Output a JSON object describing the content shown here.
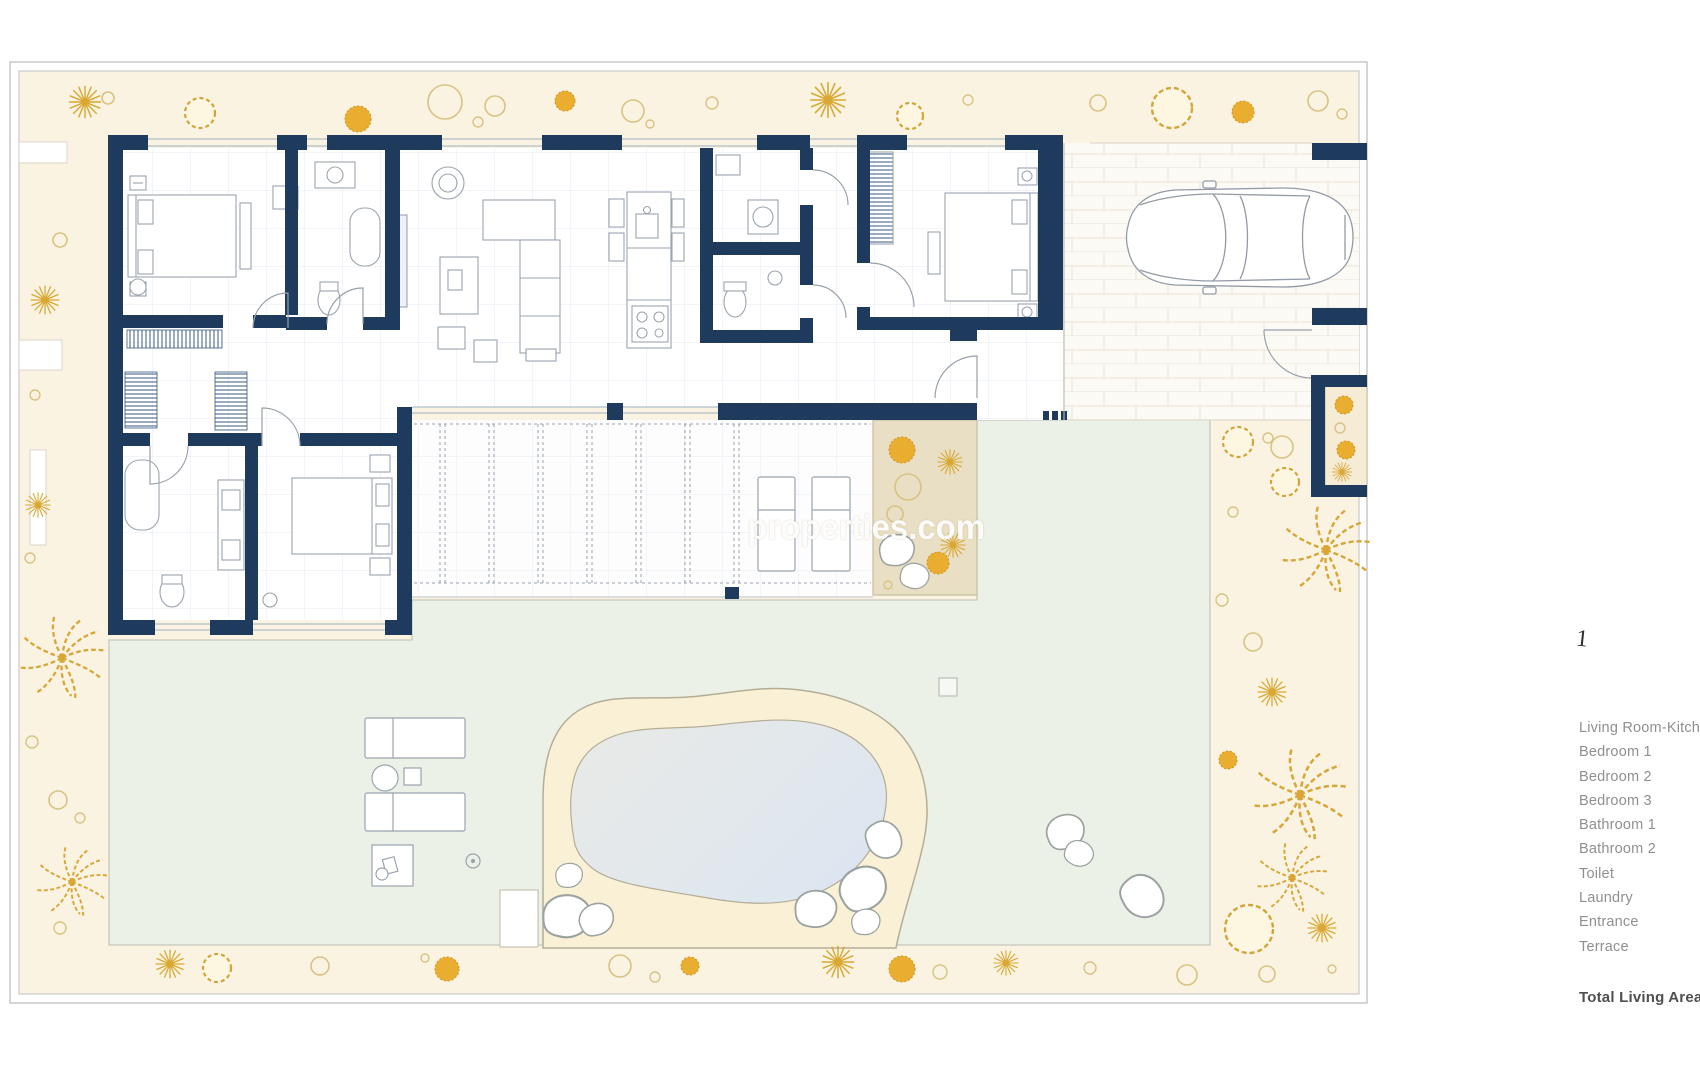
{
  "watermark": "properties.com",
  "plan": {
    "scale_mark": "1"
  },
  "legend": {
    "items": [
      "Living Room-Kitchen",
      "Bedroom 1",
      "Bedroom  2",
      "Bedroom  3",
      "Bathroom 1",
      "Bathroom 2",
      "Toilet",
      "Laundry",
      "Entrance",
      "Terrace"
    ],
    "total_label": "Total Living Area"
  },
  "colors": {
    "wall_navy": "#1e3b5e",
    "garden_cream": "#fbf3e2",
    "gold_accent": "#dba832",
    "lawn_green": "#ebf1e6",
    "pool_water": "#e2e8ee",
    "pool_sand": "#faf0d6",
    "legend_text": "#8f8f8f"
  }
}
